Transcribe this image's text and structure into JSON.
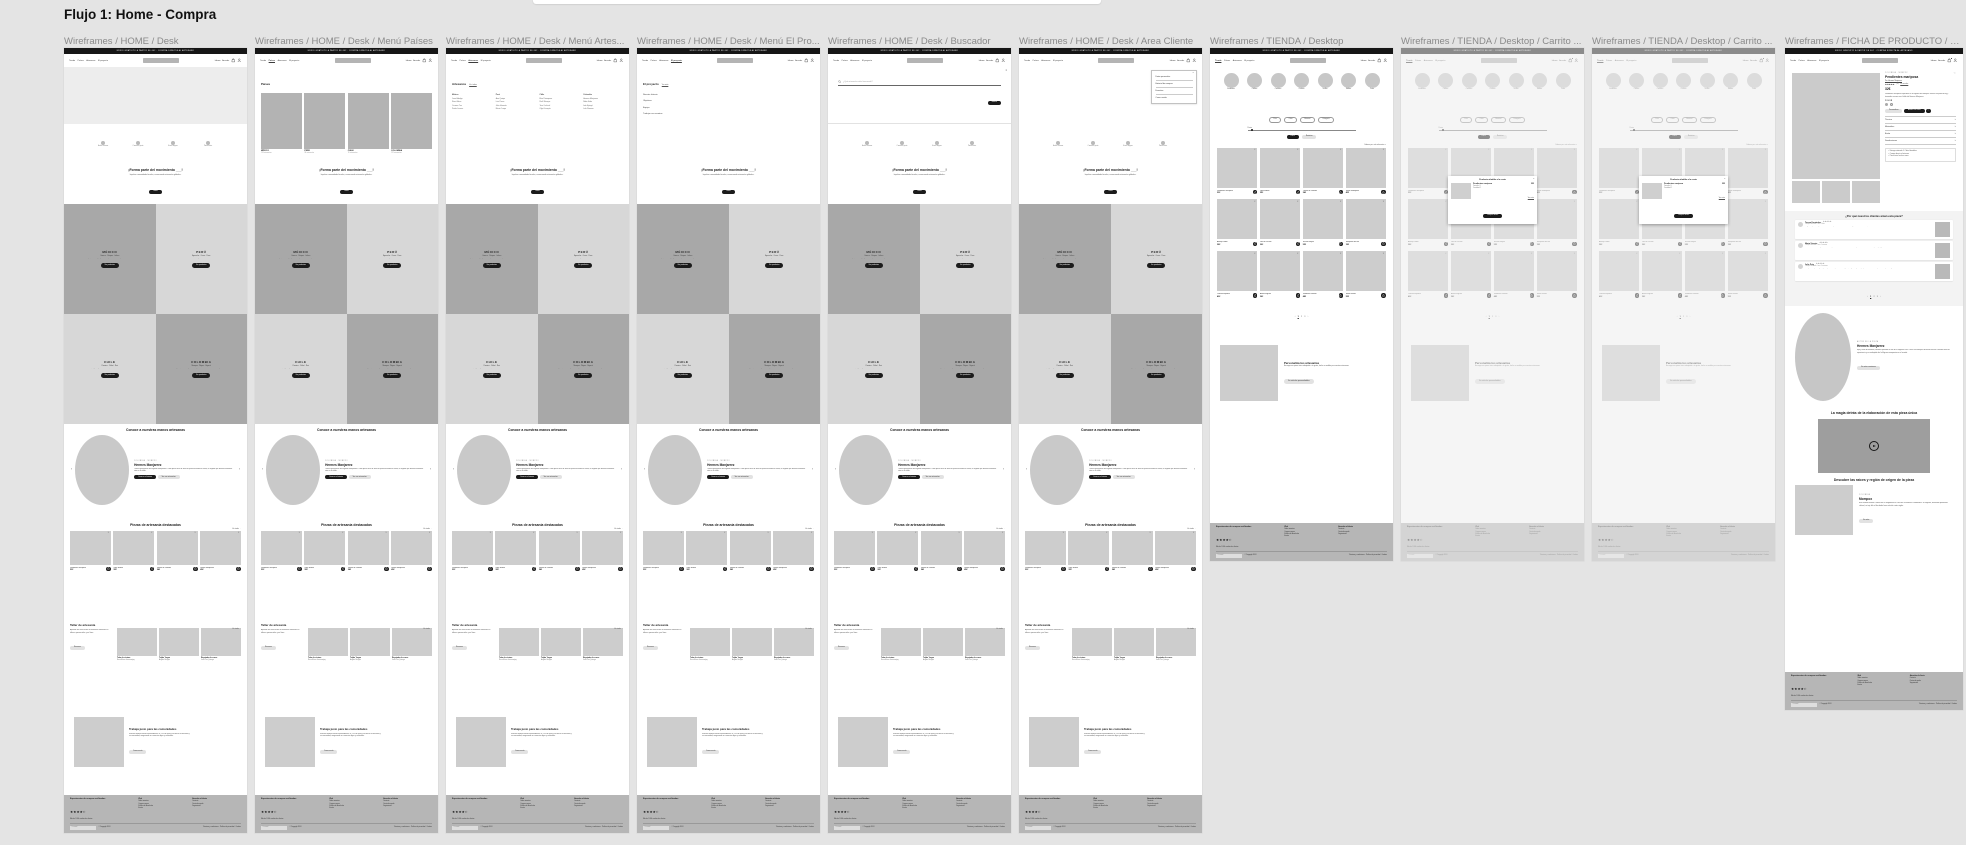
{
  "canvas": {
    "title": "Flujo 1: Home - Compra"
  },
  "header": {
    "announcement": "ENVÍO GRATUITO A PARTIR DE 60€ · COMPRA DIRECTA AL ARTESANO",
    "nav": [
      "Tienda",
      "Países",
      "Artesanos",
      "El proyecto"
    ],
    "right": [
      "Idioma",
      "Acceder"
    ]
  },
  "icons": {
    "bag": "bag-icon",
    "user": "user-icon",
    "heart": "heart-icon",
    "close": "close-icon",
    "search": "search-icon",
    "chevron": "chevron-down-icon",
    "play": "play-icon",
    "cart": "cart-icon"
  },
  "home": {
    "features": [
      {
        "label": "Hecho a mano"
      },
      {
        "label": "Comercio justo"
      },
      {
        "label": "Envío seguro"
      },
      {
        "label": "Pieza única"
      }
    ],
    "cta": {
      "title": "¡Forma parte del movimiento ___!",
      "subtitle": "Impulsa comunidades locales, conservando artesanías globales.",
      "button": "Únete"
    },
    "countries": [
      {
        "name": "MÉXICO",
        "tags": "Oaxaca · Chiapas · Jalisco",
        "desc": "Alebrijes, barro negro y textiles zapotecos hechos por manos maestras.",
        "button": "Ver productos",
        "shade": "dark"
      },
      {
        "name": "PERÚ",
        "tags": "Ayacucho · Cusco · Puno",
        "desc": "Técnicas ancestrales que unen los Andes con tu casa.",
        "button": "Ver productos",
        "shade": "light"
      },
      {
        "name": "CHILE",
        "tags": "Pomaire · Chiloé · Rari",
        "desc": "El crin, la greda y la lana chilota, tradición viva del sur del mundo.",
        "button": "Ver productos",
        "shade": "light"
      },
      {
        "name": "COLOMBIA",
        "tags": "Mompox · Wayuu · Boyacá",
        "desc": "Filigrana, mochilas y cerámica que cuentan historias del Caribe y los Andes.",
        "button": "Ver productos",
        "shade": "dark"
      }
    ],
    "artisans": {
      "heading": "Conoce a nuestras manos artesanas",
      "eyebrow": "COLOMBIA · MOMPOX",
      "name": "Hermes Manjarrez",
      "desc": "Tercera generación de filigrana momposina. Cada pieza nace de hilos de plata trenzados a mano, un legado que Hermes mantiene vivo en su taller.",
      "primary": "Conoce su historia",
      "secondary": "Ver sus artesanías",
      "prev": "‹",
      "next": "›"
    },
    "products": {
      "heading": "Piezas de artesanía destacadas",
      "link": "Ver todas →"
    },
    "taller": {
      "title": "Taller de artesanía",
      "desc": "Aprende las técnicas de los maestros artesanos en talleres presenciales y en línea.",
      "button": "Reservar",
      "link": "Ver todos →",
      "items": [
        {
          "title": "Telar de cintura",
          "author": "Rosa Elena Jacanamijoy"
        },
        {
          "title": "Tejido Yagua",
          "author": "Ángela Rengifo"
        },
        {
          "title": "Repujado de cuero",
          "author": "José Luis Quiroga"
        }
      ]
    },
    "fair": {
      "title": "Trabaja justo para las comunidades",
      "desc": "Nuestro modelo elimina intermediarios: el 70% del precio va directo al artesano y su comunidad, asegurando un comercio digno y sostenible.",
      "button": "Conoce más"
    }
  },
  "menus": {
    "paises": {
      "heading": "Países",
      "items": [
        {
          "name": "MÉXICO",
          "sub": "124 artesanías"
        },
        {
          "name": "PERÚ",
          "sub": "98 artesanías"
        },
        {
          "name": "CHILE",
          "sub": "76 artesanías"
        },
        {
          "name": "COLOMBIA",
          "sub": "112 artesanías"
        }
      ]
    },
    "artesanos": {
      "heading": "Artesanos",
      "link": "Ver todos",
      "columns": [
        {
          "country": "México",
          "names": [
            "Juan Hidalgo",
            "Rosa Elena",
            "Carmen Tux",
            "Pedro Linares"
          ]
        },
        {
          "country": "Perú",
          "names": [
            "Ana Quispe",
            "Luis Poma",
            "Julia Huamán",
            "Mario Ccopa"
          ]
        },
        {
          "country": "Chile",
          "names": [
            "Elsa Painequeo",
            "Raúl Manque",
            "Tere Curihual",
            "Olga Llanquín"
          ]
        },
        {
          "country": "Colombia",
          "names": [
            "Hermes Manjarrez",
            "Nidia Uribe",
            "Iván Epiayú",
            "Lola Romero"
          ]
        }
      ]
    },
    "proyecto": {
      "heading": "El proyecto",
      "link": "Ver más",
      "items": [
        "Nuestra historia",
        "Objetivos",
        "Equipo",
        "Trabaja con nosotros"
      ]
    },
    "buscador": {
      "placeholder": "¿Qué artesanía estás buscando?",
      "button": "Buscar"
    },
    "cliente": {
      "items": [
        "Datos personales",
        "Historial de compras",
        "Favoritos",
        "Cerrar sesión"
      ]
    }
  },
  "products": [
    {
      "tag": "COLOMBIA · PLATA",
      "name": "Pendientes mariposa",
      "price": "32€"
    },
    {
      "tag": "PERÚ · TEXTIL",
      "name": "Tapiz andino",
      "price": "30€"
    },
    {
      "tag": "CHILE · GREDA",
      "name": "Fuente de Pomaire",
      "price": "24€"
    },
    {
      "tag": "MÉXICO · BARRO",
      "name": "Jarrón oaxaqueño",
      "price": "45€"
    },
    {
      "tag": "MÉXICO · MADERA",
      "name": "Alebrije colibrí",
      "price": "38€"
    },
    {
      "tag": "PERÚ · CERÁMICA",
      "name": "Toro de Pucará",
      "price": "30€"
    },
    {
      "tag": "COLOMBIA · WAYUU",
      "name": "Mochila wayuu",
      "price": "55€"
    },
    {
      "tag": "CHILE · CRIN",
      "name": "Mariposas de Rari",
      "price": "18€"
    },
    {
      "tag": "MÉXICO · TEXTIL",
      "name": "Camino zapoteco",
      "price": "40€"
    },
    {
      "tag": "PERÚ · PLATA",
      "name": "Aretes filigrana",
      "price": "36€"
    },
    {
      "tag": "COLOMBIA · PALMA",
      "name": "Sombrero vueltiao",
      "price": "48€"
    },
    {
      "tag": "CHILE · LANA",
      "name": "Manta chilota",
      "price": "52€"
    }
  ],
  "tienda": {
    "categories": [
      "Pendientes",
      "Collares",
      "Cerámica",
      "Cestería",
      "Textiles",
      "Madera",
      "Cuero"
    ],
    "filters": [
      "País",
      "Color",
      "Material",
      "Categoría"
    ],
    "price_label": "Precio",
    "apply": "Filtrar",
    "reset": "Reiniciar",
    "sort": "Ordenar por: más relevantes ∨",
    "pagination": [
      "‹",
      "1",
      "2",
      "3",
      "›"
    ],
    "personaliza": {
      "title": "Personaliza tus artesanías",
      "desc": "Encarga una pieza única adaptada a tu gusto, hecha a medida por nuestros artesanos.",
      "button": "Ver artículos personalizables"
    }
  },
  "modal": {
    "title": "Producto añadido a la cesta",
    "name": "Pendientes mariposa",
    "line1": "Tamaño: U",
    "line2": "Cantidad: 1",
    "price": "32€",
    "link": "Ver cesta",
    "button": "Comprar ahora",
    "close": "×"
  },
  "ficha": {
    "eyebrow": "COLOMBIA · MOMPOX",
    "title": "Pendientes mariposa",
    "author": "Por Hermes Manjarrez",
    "rating": 4.8,
    "rating_count": "(32)",
    "rating_link": "Ver reseñas",
    "price": "32€",
    "desc": "Pendientes mariposa inspirados en la filigrana de Mompox. Hechos en plata de ley y trenzados a mano en el taller de Hermes Manjarrez.",
    "color_label": "COLOR",
    "personalize": "Personalizar",
    "add": "Añadir a la cesta",
    "accordions": [
      "Técnica",
      "Materiales",
      "Envío",
      "Devoluciones"
    ],
    "bullets": [
      "✓ Entrega estimada: 5-7 días laborables",
      "✓ Compra directa al artesano",
      "✓ Pieza única hecha a mano"
    ],
    "reviews": {
      "heading": "¿Por qué nuestros clientes aman esta pieza?",
      "items": [
        {
          "name": "Teresa Fernández",
          "meta": "Compra verificada · hace 2 días",
          "stars": 5,
          "text": "Llegaron rapidísimo y son más bonitos en persona. El acabado de la filigrana es una maravilla, el artesano es un auténtico artista."
        },
        {
          "name": "Marta Vicente",
          "meta": "Compra verificada · hace 1 semana",
          "stars": 5,
          "text": "La calidad es increíble y se nota el trabajo hecho a mano. Me encanta saber quién está detrás de cada pieza y apoyar su taller directamente."
        },
        {
          "name": "Julia Puig",
          "meta": "Compra verificada · hace 3 semanas",
          "stars": 5,
          "text": "Compré unos para regalar y me quedé otros para mí. Son ligeros, elegantes y el empaquetado artesanal es precioso. Repetiré seguro."
        }
      ],
      "pagination": [
        "‹",
        "1",
        "2",
        "3",
        "›"
      ]
    },
    "artisan": {
      "eyebrow": "AUTOR DE LA PIEZA",
      "name": "Hermes Manjarrez",
      "desc": "Hijo y nieto de orfebres, Hermes aprendió el arte de la filigrana a los 9 años en Mompox. Acumula más de cuarenta años de experiencia y es embajador de la filigrana momposina en el mundo.",
      "button": "Ver más creaciones"
    },
    "video_heading": "La magia detrás de la elaboración de esta pieza única",
    "region": {
      "heading": "Descubre las raíces y región de origen de la pieza",
      "eyebrow": "COLOMBIA",
      "name": "Mompox",
      "desc": "Esta ciudad colonial a orillas del río Magdalena es cuna de la orfebrería colombiana. Su filigrana, declarada patrimonio cultural, se teje hilo a hilo desde hace más de cuatro siglos.",
      "button": "Ver más"
    }
  },
  "footer": {
    "rating_title": "Experiencias de compra verificadas",
    "rating": 4.5,
    "rating_caption": "Más de 2.000 reseñas de clientes",
    "col1_title": "Web",
    "col1_links": [
      "Sobre nosotros",
      "Compra segura",
      "Política de devolución",
      "Envíos"
    ],
    "col2_title": "Atención al cliente",
    "col2_links": [
      "Contacto",
      "Centro de ayuda",
      "Seguimiento"
    ],
    "newsletter_placeholder": "Tu email",
    "copyright": "© Copyright 2024",
    "legal": "Términos y condiciones · Política de privacidad · Cookies"
  },
  "frames": [
    {
      "label": "Wireframes / HOME / Desk",
      "type": "home"
    },
    {
      "label": "Wireframes / HOME / Desk / Menú Países",
      "type": "home",
      "variant": "paises"
    },
    {
      "label": "Wireframes / HOME / Desk / Menú Artes...",
      "type": "home",
      "variant": "artesanos"
    },
    {
      "label": "Wireframes / HOME / Desk / Menú El Pro...",
      "type": "home",
      "variant": "proyecto"
    },
    {
      "label": "Wireframes / HOME / Desk / Buscador",
      "type": "home",
      "variant": "buscador"
    },
    {
      "label": "Wireframes / HOME / Desk / Area Cliente",
      "type": "home",
      "variant": "cliente"
    },
    {
      "label": "Wireframes / TIENDA / Desktop",
      "type": "tienda"
    },
    {
      "label": "Wireframes / TIENDA / Desktop / Carrito ...",
      "type": "tienda",
      "variant": "modal"
    },
    {
      "label": "Wireframes / TIENDA / Desktop / Carrito ...",
      "type": "tienda",
      "variant": "modal"
    },
    {
      "label": "Wireframes / FICHA DE PRODUCTO / De...",
      "type": "ficha"
    }
  ]
}
